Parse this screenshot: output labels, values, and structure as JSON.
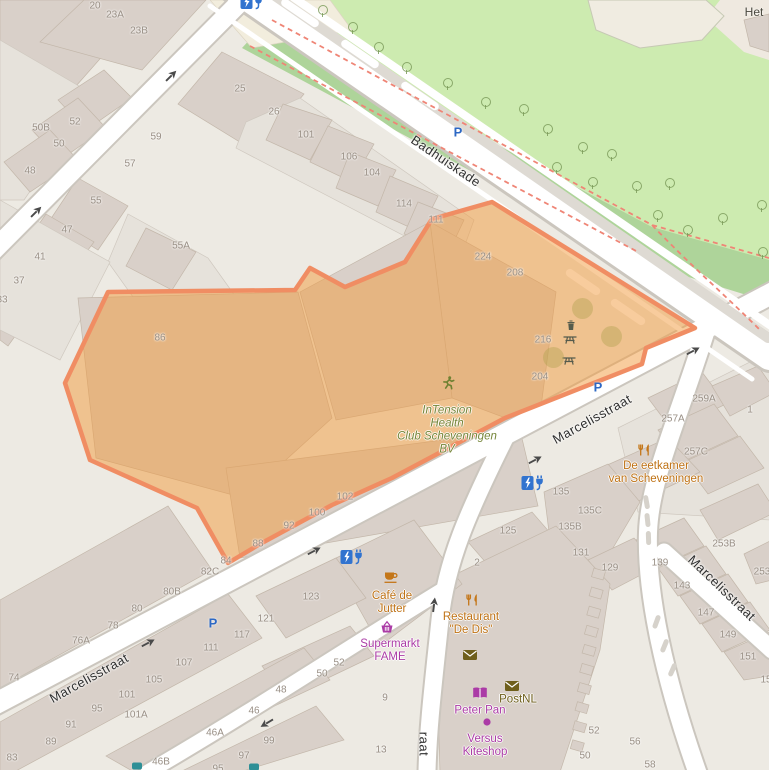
{
  "map": {
    "colors": {
      "selection_fill": "rgba(242,153,60,0.5)",
      "selection_stroke": "#f08d63",
      "park_light": "#cdebb0",
      "park_dark": "#aed49a",
      "building": "#d9d0c9",
      "street": "#ffffff",
      "path_dashed": "#ef8576",
      "parking_blue": "#2d68c4",
      "charger_blue": "#3173cf",
      "poi_orange": "#bf7215",
      "poi_purple": "#ab3ba6",
      "poi_green": "#76863a"
    },
    "street_labels": [
      {
        "text": "Badhuiskade",
        "x": 446,
        "y": 161,
        "angle": 34
      },
      {
        "text": "Marcelisstraat",
        "x": 592,
        "y": 419,
        "angle": -29
      },
      {
        "text": "Marcelisstraat",
        "x": 89,
        "y": 678,
        "angle": -29
      },
      {
        "text": "Marcelisstraat",
        "x": 722,
        "y": 588,
        "angle": 44
      },
      {
        "text": "raat",
        "x": 424,
        "y": 744,
        "angle": 90
      }
    ],
    "place_labels": [
      {
        "text": "Het",
        "x": 754,
        "y": 12
      }
    ],
    "housenumbers": [
      {
        "t": "20",
        "x": 95,
        "y": 6
      },
      {
        "t": "23A",
        "x": 115,
        "y": 15
      },
      {
        "t": "23B",
        "x": 139,
        "y": 31
      },
      {
        "t": "25",
        "x": 240,
        "y": 89
      },
      {
        "t": "26",
        "x": 274,
        "y": 112
      },
      {
        "t": "52",
        "x": 75,
        "y": 122
      },
      {
        "t": "50B",
        "x": 41,
        "y": 128
      },
      {
        "t": "50",
        "x": 59,
        "y": 144
      },
      {
        "t": "48",
        "x": 30,
        "y": 171
      },
      {
        "t": "59",
        "x": 156,
        "y": 137
      },
      {
        "t": "57",
        "x": 130,
        "y": 164
      },
      {
        "t": "55",
        "x": 96,
        "y": 201
      },
      {
        "t": "55A",
        "x": 181,
        "y": 246
      },
      {
        "t": "47",
        "x": 67,
        "y": 230
      },
      {
        "t": "41",
        "x": 40,
        "y": 257
      },
      {
        "t": "37",
        "x": 19,
        "y": 281
      },
      {
        "t": "33",
        "x": 2,
        "y": 300
      },
      {
        "t": "86",
        "x": 160,
        "y": 338
      },
      {
        "t": "101",
        "x": 306,
        "y": 135
      },
      {
        "t": "106",
        "x": 349,
        "y": 157
      },
      {
        "t": "104",
        "x": 372,
        "y": 173
      },
      {
        "t": "114",
        "x": 404,
        "y": 204
      },
      {
        "t": "111",
        "x": 436,
        "y": 220
      },
      {
        "t": "224",
        "x": 483,
        "y": 257
      },
      {
        "t": "208",
        "x": 515,
        "y": 273
      },
      {
        "t": "216",
        "x": 543,
        "y": 340
      },
      {
        "t": "204",
        "x": 540,
        "y": 377
      },
      {
        "t": "102",
        "x": 345,
        "y": 497
      },
      {
        "t": "100",
        "x": 317,
        "y": 513
      },
      {
        "t": "92",
        "x": 289,
        "y": 526
      },
      {
        "t": "88",
        "x": 258,
        "y": 544
      },
      {
        "t": "84",
        "x": 226,
        "y": 561
      },
      {
        "t": "82C",
        "x": 210,
        "y": 572
      },
      {
        "t": "80B",
        "x": 172,
        "y": 592
      },
      {
        "t": "80",
        "x": 137,
        "y": 609
      },
      {
        "t": "78",
        "x": 113,
        "y": 626
      },
      {
        "t": "76A",
        "x": 81,
        "y": 641
      },
      {
        "t": "74",
        "x": 14,
        "y": 678
      },
      {
        "t": "117",
        "x": 242,
        "y": 635
      },
      {
        "t": "111",
        "x": 211,
        "y": 648
      },
      {
        "t": "107",
        "x": 184,
        "y": 663
      },
      {
        "t": "105",
        "x": 154,
        "y": 680
      },
      {
        "t": "101",
        "x": 127,
        "y": 695
      },
      {
        "t": "95",
        "x": 97,
        "y": 709
      },
      {
        "t": "101A",
        "x": 136,
        "y": 715
      },
      {
        "t": "91",
        "x": 71,
        "y": 725
      },
      {
        "t": "89",
        "x": 51,
        "y": 742
      },
      {
        "t": "83",
        "x": 12,
        "y": 758
      },
      {
        "t": "46",
        "x": 254,
        "y": 711
      },
      {
        "t": "46A",
        "x": 215,
        "y": 733
      },
      {
        "t": "46B",
        "x": 161,
        "y": 762
      },
      {
        "t": "99",
        "x": 269,
        "y": 741
      },
      {
        "t": "97",
        "x": 244,
        "y": 756
      },
      {
        "t": "95",
        "x": 218,
        "y": 769
      },
      {
        "t": "123",
        "x": 311,
        "y": 597
      },
      {
        "t": "121",
        "x": 266,
        "y": 619
      },
      {
        "t": "125",
        "x": 508,
        "y": 531
      },
      {
        "t": "2",
        "x": 477,
        "y": 563
      },
      {
        "t": "9",
        "x": 385,
        "y": 698
      },
      {
        "t": "13",
        "x": 381,
        "y": 750
      },
      {
        "t": "52",
        "x": 339,
        "y": 663
      },
      {
        "t": "50",
        "x": 322,
        "y": 674
      },
      {
        "t": "48",
        "x": 281,
        "y": 690
      },
      {
        "t": "135",
        "x": 561,
        "y": 492
      },
      {
        "t": "135C",
        "x": 590,
        "y": 511
      },
      {
        "t": "135B",
        "x": 570,
        "y": 527
      },
      {
        "t": "131",
        "x": 581,
        "y": 553
      },
      {
        "t": "129",
        "x": 610,
        "y": 568
      },
      {
        "t": "139",
        "x": 660,
        "y": 563
      },
      {
        "t": "143",
        "x": 682,
        "y": 586
      },
      {
        "t": "147",
        "x": 706,
        "y": 613
      },
      {
        "t": "149",
        "x": 728,
        "y": 635
      },
      {
        "t": "151",
        "x": 748,
        "y": 657
      },
      {
        "t": "15",
        "x": 766,
        "y": 680
      },
      {
        "t": "253B",
        "x": 724,
        "y": 544
      },
      {
        "t": "253",
        "x": 762,
        "y": 572
      },
      {
        "t": "259A",
        "x": 704,
        "y": 399
      },
      {
        "t": "257A",
        "x": 673,
        "y": 419
      },
      {
        "t": "257C",
        "x": 696,
        "y": 452
      },
      {
        "t": "1",
        "x": 750,
        "y": 410
      },
      {
        "t": "52",
        "x": 594,
        "y": 731
      },
      {
        "t": "56",
        "x": 635,
        "y": 742
      },
      {
        "t": "50",
        "x": 585,
        "y": 756
      },
      {
        "t": "58",
        "x": 650,
        "y": 765
      }
    ],
    "pois": [
      {
        "id": "intension",
        "lines": [
          "InTension",
          "Health",
          "Club Scheveningen",
          "BV"
        ],
        "x": 447,
        "y": 430,
        "color": "green",
        "icon": "runner-icon",
        "ix": 448,
        "iy": 383
      },
      {
        "id": "eetkamer",
        "lines": [
          "De eetkamer",
          "van Scheveningen"
        ],
        "x": 656,
        "y": 473,
        "color": "orange",
        "icon": "cutlery-icon",
        "ix": 644,
        "iy": 450
      },
      {
        "id": "restaurant-de-dis",
        "lines": [
          "Restaurant",
          "\"De Dis\""
        ],
        "x": 471,
        "y": 624,
        "color": "orange",
        "icon": "cutlery-icon",
        "ix": 472,
        "iy": 600
      },
      {
        "id": "cafe-de-jutter",
        "lines": [
          "Café de",
          "Jutter"
        ],
        "x": 392,
        "y": 603,
        "color": "orange",
        "icon": "cup-icon",
        "ix": 391,
        "iy": 577
      },
      {
        "id": "supermarkt-fame",
        "lines": [
          "Supermarkt",
          "FAME"
        ],
        "x": 390,
        "y": 651,
        "color": "purple",
        "icon": "basket-icon",
        "ix": 387,
        "iy": 627
      },
      {
        "id": "postnl",
        "lines": [
          "PostNL"
        ],
        "x": 518,
        "y": 700,
        "color": "olive",
        "icon": "mail-icon",
        "ix": 512,
        "iy": 686
      },
      {
        "id": "peter-pan",
        "lines": [
          "Peter Pan"
        ],
        "x": 480,
        "y": 711,
        "color": "purple",
        "icon": "book-icon",
        "ix": 480,
        "iy": 693
      },
      {
        "id": "versus-kiteshop",
        "lines": [
          "Versus",
          "Kiteshop"
        ],
        "x": 485,
        "y": 746,
        "color": "purple",
        "icon": "dot-icon",
        "ix": 487,
        "iy": 722
      }
    ],
    "amenity_icons": [
      {
        "icon": "mail-icon",
        "x": 470,
        "y": 655,
        "color": "olive"
      },
      {
        "icon": "waste-bin-icon",
        "x": 571,
        "y": 325,
        "color": "darkgreen"
      },
      {
        "icon": "picnic-table-icon",
        "x": 570,
        "y": 339,
        "color": "darkgreen"
      },
      {
        "icon": "picnic-table-icon",
        "x": 569,
        "y": 360,
        "color": "darkgreen"
      }
    ],
    "parking": [
      {
        "label": "P",
        "x": 458,
        "y": 132
      },
      {
        "label": "P",
        "x": 598,
        "y": 387
      },
      {
        "label": "P",
        "x": 213,
        "y": 623
      }
    ],
    "chargers": [
      {
        "x": 252,
        "y": 2
      },
      {
        "x": 533,
        "y": 483
      },
      {
        "x": 352,
        "y": 557
      }
    ],
    "oneway_arrows": [
      {
        "x": 36,
        "y": 212,
        "a": -45
      },
      {
        "x": 171,
        "y": 76,
        "a": -45
      },
      {
        "x": 148,
        "y": 643,
        "a": -28
      },
      {
        "x": 314,
        "y": 551,
        "a": -28
      },
      {
        "x": 535,
        "y": 460,
        "a": -28
      },
      {
        "x": 693,
        "y": 351,
        "a": -28
      },
      {
        "x": 434,
        "y": 605,
        "a": -83
      },
      {
        "x": 267,
        "y": 723,
        "a": 149
      }
    ],
    "trees_park": [
      {
        "x": 322,
        "y": 10
      },
      {
        "x": 352,
        "y": 27
      },
      {
        "x": 378,
        "y": 47
      },
      {
        "x": 406,
        "y": 67
      },
      {
        "x": 447,
        "y": 83
      },
      {
        "x": 485,
        "y": 102
      },
      {
        "x": 523,
        "y": 109
      },
      {
        "x": 547,
        "y": 129
      },
      {
        "x": 582,
        "y": 147
      },
      {
        "x": 611,
        "y": 154
      },
      {
        "x": 556,
        "y": 167
      },
      {
        "x": 592,
        "y": 182
      },
      {
        "x": 636,
        "y": 186
      },
      {
        "x": 669,
        "y": 183
      },
      {
        "x": 657,
        "y": 215
      },
      {
        "x": 687,
        "y": 230
      },
      {
        "x": 722,
        "y": 218
      },
      {
        "x": 761,
        "y": 205
      },
      {
        "x": 762,
        "y": 252
      }
    ],
    "trees_selection": [
      {
        "x": 582,
        "y": 308
      },
      {
        "x": 611,
        "y": 336
      },
      {
        "x": 553,
        "y": 357
      }
    ],
    "cutoff_icons": [
      {
        "x": 137,
        "y": 766
      },
      {
        "x": 254,
        "y": 767
      }
    ]
  }
}
